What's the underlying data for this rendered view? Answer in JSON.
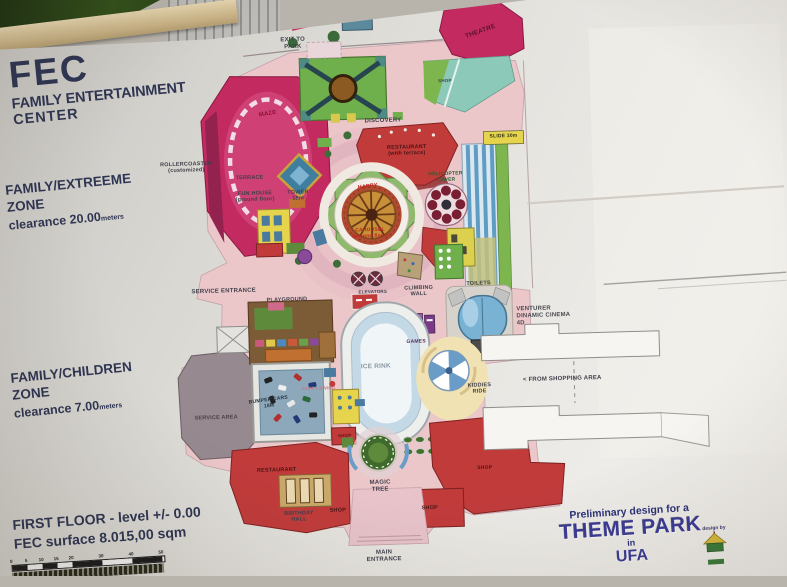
{
  "poster": {
    "title": {
      "line1": "FEC",
      "line2": "FAMILY ENTERTAINMENT",
      "line3": "CENTER"
    },
    "zone_extreme": {
      "name": "FAMILY/EXTREEME",
      "word": "ZONE",
      "clearance": "clearance 20.00",
      "unit": "meters"
    },
    "zone_children": {
      "name": "FAMILY/CHILDREN",
      "word": "ZONE",
      "clearance": "clearance 7.00",
      "unit": "meters"
    },
    "floor": {
      "line1": "FIRST FLOOR - level +/- 0.00",
      "line2": "FEC surface 8.015,00 sqm"
    },
    "scale_bar": {
      "ticks": [
        0,
        5,
        10,
        15,
        20,
        30,
        40,
        50
      ],
      "px_per_meter": 3
    },
    "credits": {
      "intro": "Preliminary design for a",
      "title": "THEME PARK",
      "mid": "in",
      "city": "UFA",
      "design_by": "design by"
    }
  },
  "colors": {
    "poster_bg": "#e2e0db",
    "text_navy": "#2e3552",
    "credits_blue": "#3a3a95",
    "magenta": "#c22a60",
    "red": "#c13b3b",
    "green": "#6fb04c",
    "teal": "#8cc9b8",
    "pink_floor": "#ecc7ca",
    "slide_blue": "#5f9dc4",
    "yellow": "#e6d44c"
  },
  "map": {
    "labels": [
      {
        "name": "label-exit-to-park",
        "text": "EXIT TO\nPARK",
        "x": 300,
        "y": 41,
        "size": 6
      },
      {
        "name": "label-theatre",
        "text": "THEATRE",
        "x": 488,
        "y": 34,
        "size": 6.5,
        "color": "#5a1430",
        "rotate": -18
      },
      {
        "name": "label-shop-top",
        "text": "SHOP",
        "x": 451,
        "y": 82,
        "size": 4.5,
        "color": "#3a4a4a"
      },
      {
        "name": "label-maze",
        "text": "MAZE",
        "x": 273,
        "y": 111,
        "size": 6,
        "color": "#8a1535",
        "rotate": -8
      },
      {
        "name": "label-discovery",
        "text": "DISCOVERY",
        "x": 388,
        "y": 121,
        "size": 6
      },
      {
        "name": "label-restaurant-terrace",
        "text": "RESTAURANT\n(with terrace)",
        "x": 411,
        "y": 151,
        "size": 5.5,
        "color": "#4a1515"
      },
      {
        "name": "label-slide",
        "text": "SLIDE 30m",
        "x": 508,
        "y": 140,
        "size": 5,
        "color": "#33331a"
      },
      {
        "name": "label-helicopter-tower",
        "text": "HELICOPTER\nTOWER",
        "x": 449,
        "y": 179,
        "size": 5,
        "color": "#2b5e33"
      },
      {
        "name": "label-rollercoaster",
        "text": "ROLLERCOASTER\n(customized)",
        "x": 190,
        "y": 162,
        "size": 5.5
      },
      {
        "name": "label-terrace",
        "text": "TERRACE",
        "x": 253,
        "y": 174,
        "size": 5.5
      },
      {
        "name": "label-fun-house",
        "text": "FUN HOUSE\n(ground floor)",
        "x": 258,
        "y": 193,
        "size": 5.5
      },
      {
        "name": "label-tower-18m",
        "text": "TOWER\n18m",
        "x": 301,
        "y": 193,
        "size": 5.5
      },
      {
        "name": "label-carousel-top",
        "text": "HAPPY",
        "x": 371,
        "y": 186,
        "size": 5.5,
        "color": "#c02020",
        "rotate": -5
      },
      {
        "name": "label-carousel-bottom",
        "text": "CAROUSEL\n(second floor)",
        "x": 372,
        "y": 233,
        "size": 5,
        "color": "#c02020"
      },
      {
        "name": "label-service-entrance",
        "text": "SERVICE ENTRANCE",
        "x": 224,
        "y": 287,
        "size": 6
      },
      {
        "name": "label-playground",
        "text": "PLAYGROUND",
        "x": 287,
        "y": 297,
        "size": 5.5
      },
      {
        "name": "label-elevators",
        "text": "ELEVATORS",
        "x": 373,
        "y": 291,
        "size": 4.5
      },
      {
        "name": "label-climbing-wall",
        "text": "CLIMBING\nWALL",
        "x": 419,
        "y": 292,
        "size": 5.5
      },
      {
        "name": "label-toilets",
        "text": "TOILETS",
        "x": 479,
        "y": 286,
        "size": 5.5
      },
      {
        "name": "label-games",
        "text": "GAMES",
        "x": 415,
        "y": 343,
        "size": 5,
        "color": "#5a2a5a"
      },
      {
        "name": "label-venturer-cinema",
        "text": "VENTURER\nDINAMIC CINEMA\n4D",
        "x": 516,
        "y": 320,
        "size": 6,
        "anchor": "left",
        "align": "left",
        "color": "#4a4a50"
      },
      {
        "name": "label-ice-rink",
        "text": "ICE RINK",
        "x": 374,
        "y": 366,
        "size": 6.5,
        "color": "#8a98a4"
      },
      {
        "name": "label-kiddies-ride",
        "text": "KIDDIES\nRIDE",
        "x": 477,
        "y": 391,
        "size": 5.5
      },
      {
        "name": "label-from-shopping",
        "text": "<  FROM SHOPPING AREA",
        "x": 560,
        "y": 384,
        "size": 6
      },
      {
        "name": "label-service-area",
        "text": "SERVICE AREA",
        "x": 213,
        "y": 413,
        "size": 5.5,
        "color": "#4a4248"
      },
      {
        "name": "label-bumper-cars",
        "text": "BUMPER CARS\n18M",
        "x": 266,
        "y": 400,
        "size": 5,
        "color": "#2a3440",
        "rotate": -6
      },
      {
        "name": "label-happy-swing",
        "text": "HAPPY SWING",
        "x": 316,
        "y": 386,
        "size": 4.5,
        "color": "#c87888"
      },
      {
        "name": "label-shop-mid",
        "text": "SHOP",
        "x": 341,
        "y": 434,
        "size": 4.5,
        "color": "#5c1616"
      },
      {
        "name": "label-restaurant-bottom",
        "text": "RESTAURANT",
        "x": 272,
        "y": 467,
        "size": 5.5,
        "color": "#4a1515"
      },
      {
        "name": "label-birthday-hall",
        "text": "BIRTHDAY\nHALL",
        "x": 293,
        "y": 514,
        "size": 5.5
      },
      {
        "name": "label-shop-bottom-left",
        "text": "SHOP",
        "x": 332,
        "y": 509,
        "size": 5.5,
        "color": "#4a1515"
      },
      {
        "name": "label-magic-tree",
        "text": "MAGIC\nTREE",
        "x": 375,
        "y": 486,
        "size": 6
      },
      {
        "name": "label-shop-bottom-right",
        "text": "SHOP",
        "x": 424,
        "y": 509,
        "size": 5.5,
        "color": "#4a1515"
      },
      {
        "name": "label-shop-far-right",
        "text": "SHOP",
        "x": 480,
        "y": 471,
        "size": 5,
        "color": "#4a1515"
      },
      {
        "name": "label-main-entrance",
        "text": "MAIN\nENTRANCE",
        "x": 377,
        "y": 556,
        "size": 6
      }
    ]
  }
}
